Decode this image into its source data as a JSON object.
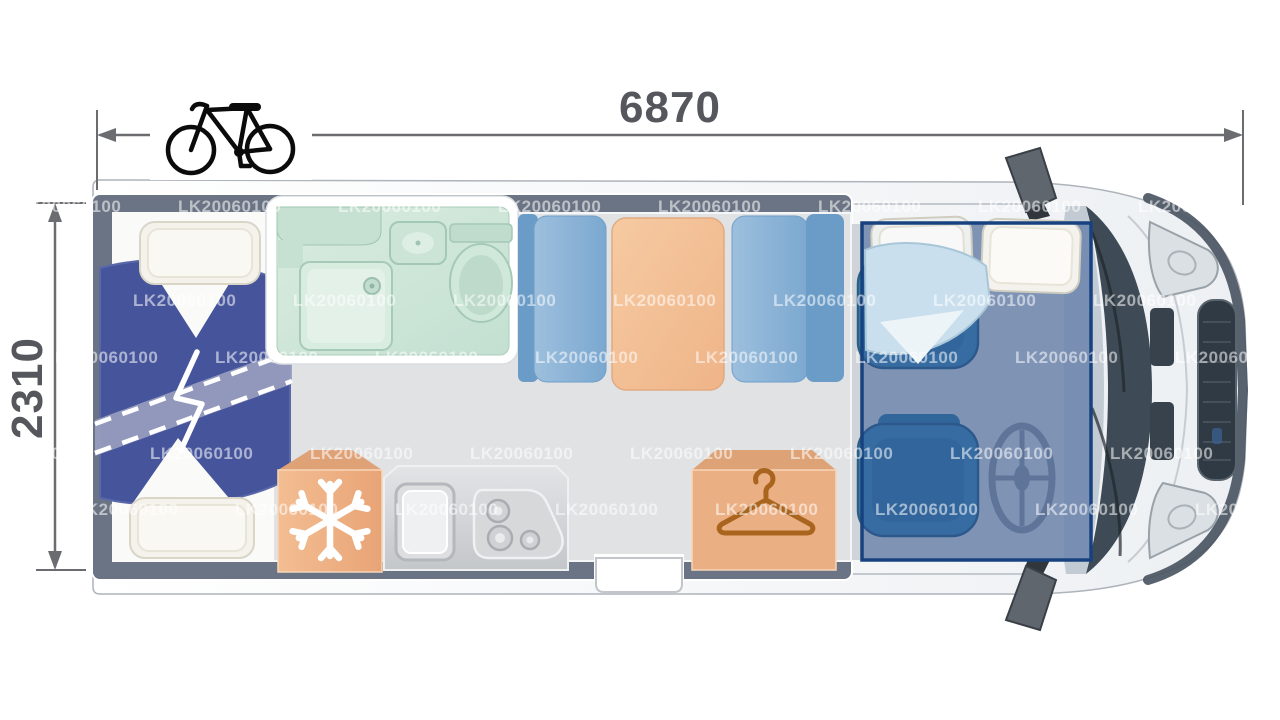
{
  "page": {
    "type": "Motorhome floor plan, top view with drop-down cab bed highlighted",
    "background": "#ffffff"
  },
  "dimensions": {
    "length_mm": "6870",
    "width_mm": "2310"
  },
  "watermark": {
    "text": "LK20060100"
  },
  "icons": {
    "bicycle": "bicycle-icon (rear bike rack)",
    "snowflake": "snowflake-icon (fridge)",
    "hanger": "hanger-icon (wardrobe)",
    "break": "zigzag-break-icon (extendable rear bed)"
  },
  "colors": {
    "dimension_text": "#55575c",
    "dimension_line": "#6a6c70",
    "wall": "#6b7484",
    "floor": "#e0e2e4",
    "duvet_blue": "#46549b",
    "duvet_band": "#99a0c0",
    "pillow_ivory": "#f4f2ea",
    "bathroom_mint": "#cfe7d9",
    "bench_blue": "#8bb4d8",
    "table_orange": "#f3c094",
    "fridge_orange": "#f0b286",
    "wardrobe_orange": "#ebaf84",
    "hanger_brown": "#a9641e",
    "kitchen_gray": "#cdd0d3",
    "cab_seat_teal": "#3f86b2",
    "overlay_blue": "#2d5191",
    "overlay_border": "#17427f",
    "cab_body_white": "#f7f9fa",
    "grille_dark": "#2f3a44"
  }
}
